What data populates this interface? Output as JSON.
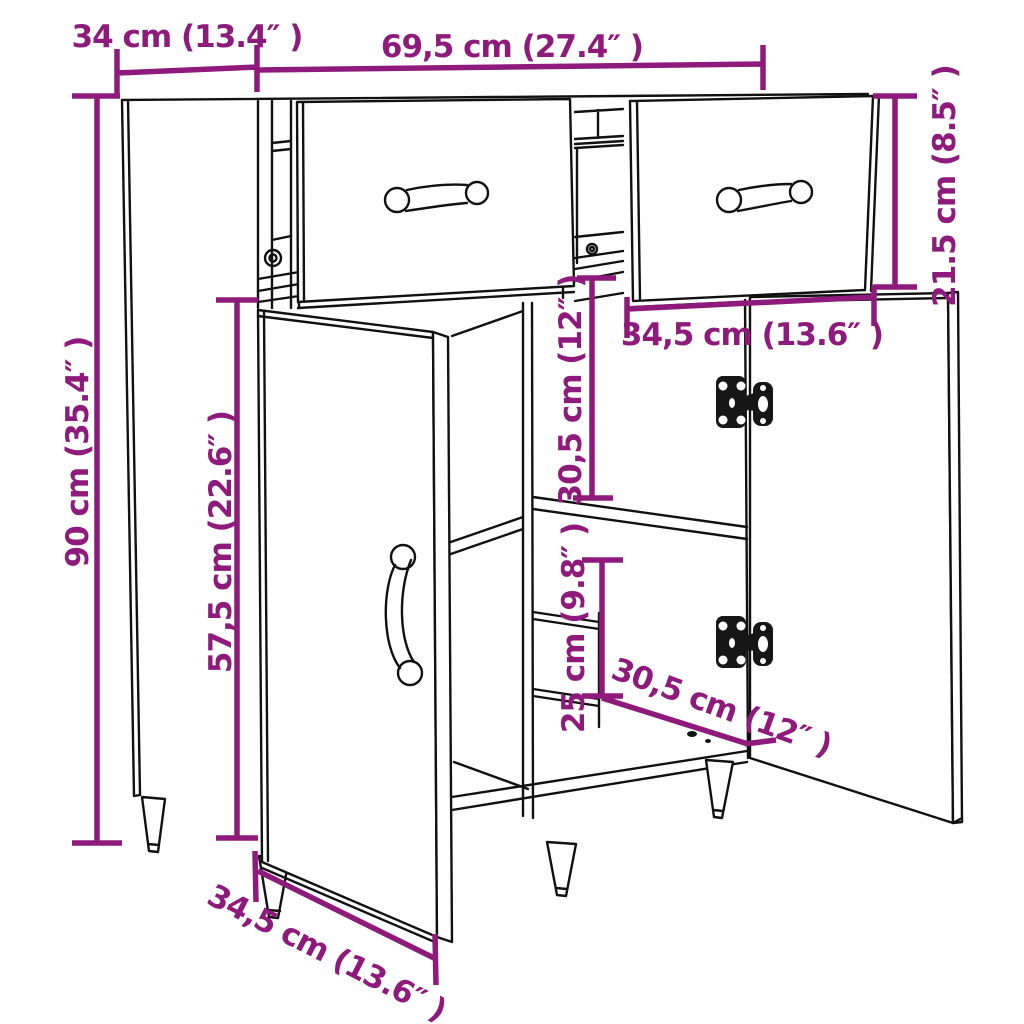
{
  "diagram": {
    "type": "product-dimension-diagram",
    "subject": "sideboard line drawing with two open drawers, two open doors, shelves, hinges and tapered legs",
    "accent_color": "#8e1b7b",
    "line_color": "#111111",
    "background_color": "#ffffff",
    "labels": {
      "depth_top": "34 cm (13.4″ )",
      "width_total": "69,5 cm (27.4″ )",
      "height_drawer": "21.5 cm (8.5″ )",
      "height_total": "90 cm (35.4″ )",
      "height_door": "57,5 cm (22.6″ )",
      "width_drawer": "34,5 cm (13.6″ )",
      "height_shelf_upper": "30,5 cm (12″ )",
      "height_shelf_lower": "25 cm (9.8″ )",
      "depth_bottom": "30,5 cm (12″ )",
      "width_door_bottom": "34,5 cm (13.6″ )"
    }
  }
}
